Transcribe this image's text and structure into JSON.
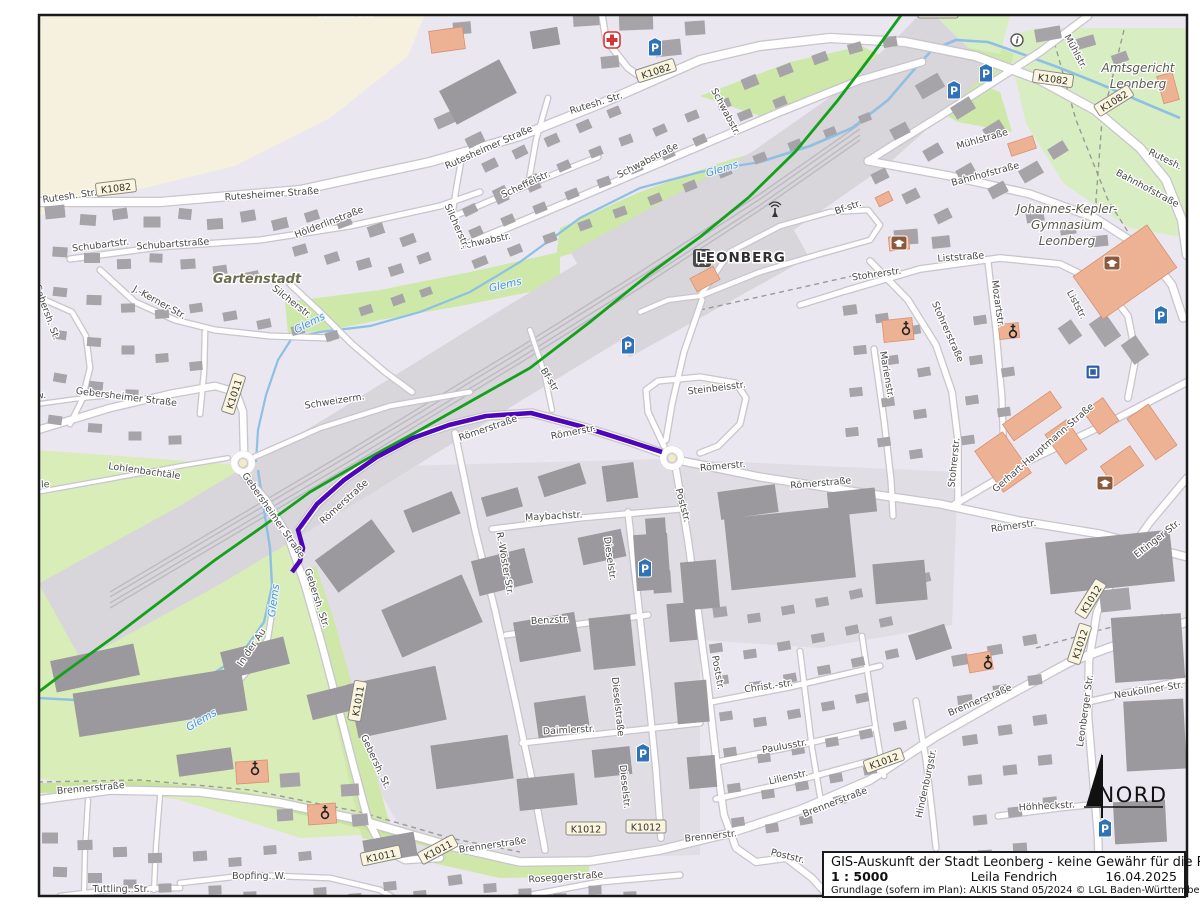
{
  "info_box": {
    "disclaimer": "GIS-Auskunft der Stadt Leonberg - keine Gewähr für die Richtigkeit",
    "scale": "1 : 5000",
    "author": "Leila Fendrich",
    "date": "16.04.2025",
    "source": "Grundlage (sofern im Plan): ALKIS Stand 05/2024 © LGL Baden-Württemberg"
  },
  "north_arrow": {
    "label": "NORD"
  },
  "map": {
    "colors": {
      "background": "#ebe7f1",
      "field": "#f6f1de",
      "grass": "#cde8a8",
      "park": "#d8eec2",
      "building": "#a6a4a8",
      "big_building": "#9b999d",
      "public_building": "#edb294",
      "water": "#8ec0e3",
      "road_fill": "#ffffff",
      "road_casing": "#c8c5cc",
      "railway_band": "#d8d5db",
      "route_highlight": "#4e06b8",
      "railway_line": "#13a01b",
      "parking_blue": "#2f72b7",
      "hospital_red": "#d23737",
      "school_brown": "#8a5a3c"
    },
    "route_highlight": {
      "name": "selected-route",
      "color": "#4e06b8",
      "width": 4.6,
      "points": "662,452 628,441 580,426 531,413 486,416 449,425 413,438 377,457 344,480 317,504 298,530 303,548 300,561 292,572"
    },
    "railway_line": {
      "color": "#13a01b",
      "width": 2.8,
      "points": "910,3 872,55 838,100 795,152 748,198 700,237 648,275 590,322 530,368 473,400 420,430 365,460 310,492 262,527 215,560 165,598 115,636 65,672 20,706"
    },
    "street_labels": [
      {
        "t": "Rütesh. Str.",
        "x": 346,
        "y": 16,
        "r": 0
      },
      {
        "t": "WhA Clausenmühle",
        "x": 1000,
        "y": 11,
        "r": 0,
        "k": "place"
      },
      {
        "t": "Rutesh. Str.",
        "x": 70,
        "y": 199,
        "r": -8
      },
      {
        "t": "Rutesheimer Straße",
        "x": 272,
        "y": 197,
        "r": -4
      },
      {
        "t": "Rutesheimer Straße",
        "x": 490,
        "y": 150,
        "r": -24
      },
      {
        "t": "Rutesh. Str.",
        "x": 597,
        "y": 106,
        "r": -17
      },
      {
        "t": "Schwabstraße",
        "x": 649,
        "y": 163,
        "r": -27
      },
      {
        "t": "Scheffelstr.",
        "x": 527,
        "y": 187,
        "r": -25
      },
      {
        "t": "Schwabstr.",
        "x": 486,
        "y": 244,
        "r": -12
      },
      {
        "t": "Schwabstr.",
        "x": 723,
        "y": 113,
        "r": 62
      },
      {
        "t": "Schubartstr.",
        "x": 101,
        "y": 248,
        "r": -7
      },
      {
        "t": "Schubartstraße",
        "x": 173,
        "y": 247,
        "r": -4
      },
      {
        "t": "Hölderlinstraße",
        "x": 330,
        "y": 225,
        "r": -21
      },
      {
        "t": "Gartenstadt",
        "x": 257,
        "y": 283,
        "r": 0,
        "k": "town"
      },
      {
        "t": "J.-Kerner-Str.",
        "x": 158,
        "y": 305,
        "r": 29
      },
      {
        "t": "Silcherstr.",
        "x": 290,
        "y": 304,
        "r": 38
      },
      {
        "t": "Silcherstr.",
        "x": 454,
        "y": 227,
        "r": 66
      },
      {
        "t": "Gebersh. St.",
        "x": 44,
        "y": 313,
        "r": 70
      },
      {
        "t": "Glems",
        "x": 506,
        "y": 288,
        "r": -13,
        "k": "water"
      },
      {
        "t": "Glems",
        "x": 311,
        "y": 326,
        "r": -27,
        "k": "water"
      },
      {
        "t": "Glems",
        "x": 723,
        "y": 172,
        "r": -17,
        "k": "water"
      },
      {
        "t": "Glems",
        "x": 203,
        "y": 723,
        "r": -30,
        "k": "water"
      },
      {
        "t": "Glems",
        "x": 277,
        "y": 601,
        "r": -82,
        "k": "water"
      },
      {
        "t": "Gebersheimer Straße",
        "x": 126,
        "y": 400,
        "r": 7
      },
      {
        "t": "bachw.",
        "x": 30,
        "y": 400,
        "r": -8
      },
      {
        "t": "Lohlenbachtäle",
        "x": 144,
        "y": 474,
        "r": 8
      },
      {
        "t": "nbachtäle",
        "x": 26,
        "y": 488,
        "r": -2
      },
      {
        "t": "Schweizerm.",
        "x": 335,
        "y": 404,
        "r": -9
      },
      {
        "t": "Gebersheimer Straße",
        "x": 271,
        "y": 517,
        "r": 55
      },
      {
        "t": "Gebersh. Str.",
        "x": 314,
        "y": 599,
        "r": 72
      },
      {
        "t": "Gebersh. St.",
        "x": 373,
        "y": 763,
        "r": 65
      },
      {
        "t": "Römerstraße",
        "x": 489,
        "y": 431,
        "r": -19
      },
      {
        "t": "Römerstr.",
        "x": 574,
        "y": 435,
        "r": -11
      },
      {
        "t": "Römerstraße",
        "x": 346,
        "y": 504,
        "r": -42
      },
      {
        "t": "Bf-str.",
        "x": 849,
        "y": 210,
        "r": -19
      },
      {
        "t": "Bf-str",
        "x": 547,
        "y": 381,
        "r": 58
      },
      {
        "t": "LEONBERG",
        "x": 741,
        "y": 262,
        "r": 0,
        "k": "station"
      },
      {
        "t": "Stohrerstr.",
        "x": 877,
        "y": 277,
        "r": -8
      },
      {
        "t": "Liststraße",
        "x": 961,
        "y": 260,
        "r": -4
      },
      {
        "t": "Stohrerstraße",
        "x": 945,
        "y": 333,
        "r": 66
      },
      {
        "t": "Mozartstr.",
        "x": 995,
        "y": 304,
        "r": 82
      },
      {
        "t": "Marienstr.",
        "x": 884,
        "y": 375,
        "r": 80
      },
      {
        "t": "Steinbeisstr.",
        "x": 717,
        "y": 391,
        "r": -7
      },
      {
        "t": "Maybachstr.",
        "x": 554,
        "y": 519,
        "r": -3
      },
      {
        "t": "R.-Wöster-Str.",
        "x": 502,
        "y": 564,
        "r": 80
      },
      {
        "t": "Dieselstr.",
        "x": 607,
        "y": 559,
        "r": 82
      },
      {
        "t": "Dieselstraße",
        "x": 615,
        "y": 707,
        "r": 84
      },
      {
        "t": "Dieselstr.",
        "x": 622,
        "y": 787,
        "r": 84
      },
      {
        "t": "Poststr.",
        "x": 680,
        "y": 506,
        "r": 75
      },
      {
        "t": "Poststr.",
        "x": 715,
        "y": 673,
        "r": 80
      },
      {
        "t": "Poststr.",
        "x": 787,
        "y": 859,
        "r": 14
      },
      {
        "t": "Benzstr.",
        "x": 550,
        "y": 623,
        "r": -3
      },
      {
        "t": "Daimlerstr.",
        "x": 569,
        "y": 733,
        "r": -3
      },
      {
        "t": "Brennerstraße",
        "x": 91,
        "y": 791,
        "r": -5
      },
      {
        "t": "Brennerstraße",
        "x": 493,
        "y": 848,
        "r": -8
      },
      {
        "t": "Roseggerstraße",
        "x": 566,
        "y": 880,
        "r": -4
      },
      {
        "t": "Bopfing. W.",
        "x": 259,
        "y": 879,
        "r": 0
      },
      {
        "t": "Tuttling. Str.",
        "x": 121,
        "y": 892,
        "r": 0
      },
      {
        "t": "Brennerstr.",
        "x": 711,
        "y": 839,
        "r": -6
      },
      {
        "t": "Brennerstraße",
        "x": 836,
        "y": 805,
        "r": -21
      },
      {
        "t": "Brennerstraße",
        "x": 981,
        "y": 703,
        "r": -23
      },
      {
        "t": "Christ.-str.",
        "x": 769,
        "y": 689,
        "r": -8
      },
      {
        "t": "Paulusstr.",
        "x": 785,
        "y": 749,
        "r": -10
      },
      {
        "t": "Lilienstr.",
        "x": 789,
        "y": 780,
        "r": -13
      },
      {
        "t": "Hindenburgstr.",
        "x": 929,
        "y": 784,
        "r": -78
      },
      {
        "t": "Höhheckstr.",
        "x": 1047,
        "y": 809,
        "r": -3
      },
      {
        "t": "Neuköllner Str.",
        "x": 1149,
        "y": 693,
        "r": -9
      },
      {
        "t": "Leonberger Str.",
        "x": 1088,
        "y": 711,
        "r": -82
      },
      {
        "t": "Eltinger Str.",
        "x": 1159,
        "y": 541,
        "r": -38
      },
      {
        "t": "Römerstr.",
        "x": 723,
        "y": 469,
        "r": -5
      },
      {
        "t": "Römerstraße",
        "x": 821,
        "y": 486,
        "r": -5
      },
      {
        "t": "Römerstr.",
        "x": 1014,
        "y": 529,
        "r": -8
      },
      {
        "t": "Gerhart-Hauptmann-Straße",
        "x": 1045,
        "y": 450,
        "r": -41
      },
      {
        "t": "Stohrerstr.",
        "x": 957,
        "y": 463,
        "r": -84
      },
      {
        "t": "Mühlstraße",
        "x": 983,
        "y": 142,
        "r": -16
      },
      {
        "t": "Bahnhofstraße",
        "x": 986,
        "y": 177,
        "r": -15
      },
      {
        "t": "Bahnhofstraße",
        "x": 1146,
        "y": 191,
        "r": 28
      },
      {
        "t": "Mühlstr.",
        "x": 1073,
        "y": 53,
        "r": 62
      },
      {
        "t": "Rutesh.",
        "x": 1164,
        "y": 162,
        "r": 26
      },
      {
        "t": "Liststr.",
        "x": 1074,
        "y": 306,
        "r": 62
      },
      {
        "t": "In der Au",
        "x": 254,
        "y": 649,
        "r": -56
      },
      {
        "t": "Amtsgericht",
        "x": 1138,
        "y": 72,
        "r": 0,
        "k": "place"
      },
      {
        "t": "Leonberg",
        "x": 1138,
        "y": 88,
        "r": 0,
        "k": "place"
      },
      {
        "t": "Johannes-Kepler-",
        "x": 1067,
        "y": 213,
        "r": 0,
        "k": "place"
      },
      {
        "t": "Gymnasium",
        "x": 1067,
        "y": 229,
        "r": 0,
        "k": "place"
      },
      {
        "t": "Leonberg",
        "x": 1067,
        "y": 245,
        "r": 0,
        "k": "place"
      }
    ],
    "road_shields": [
      {
        "t": "K1082",
        "x": 938,
        "y": 12,
        "r": 0
      },
      {
        "t": "K1082",
        "x": 116,
        "y": 188,
        "r": -7
      },
      {
        "t": "K1082",
        "x": 656,
        "y": 71,
        "r": -18
      },
      {
        "t": "K1082",
        "x": 1053,
        "y": 79,
        "r": 8
      },
      {
        "t": "K1082",
        "x": 1114,
        "y": 101,
        "r": -32
      },
      {
        "t": "K1011",
        "x": 234,
        "y": 394,
        "r": -72
      },
      {
        "t": "K1011",
        "x": 358,
        "y": 701,
        "r": -80
      },
      {
        "t": "K1011",
        "x": 381,
        "y": 856,
        "r": -12
      },
      {
        "t": "K1011",
        "x": 438,
        "y": 850,
        "r": -28
      },
      {
        "t": "K1012",
        "x": 586,
        "y": 829,
        "r": 0
      },
      {
        "t": "K1012",
        "x": 646,
        "y": 827,
        "r": 0
      },
      {
        "t": "K1012",
        "x": 884,
        "y": 761,
        "r": -20
      },
      {
        "t": "K1012",
        "x": 1091,
        "y": 599,
        "r": -58
      },
      {
        "t": "K1012",
        "x": 1080,
        "y": 644,
        "r": -72
      }
    ],
    "icons": [
      {
        "k": "hospital",
        "x": 612,
        "y": 40
      },
      {
        "k": "parking",
        "x": 655,
        "y": 47
      },
      {
        "k": "parking",
        "x": 986,
        "y": 73
      },
      {
        "k": "parking",
        "x": 954,
        "y": 90
      },
      {
        "k": "parking",
        "x": 628,
        "y": 345
      },
      {
        "k": "parking",
        "x": 645,
        "y": 568
      },
      {
        "k": "parking",
        "x": 643,
        "y": 753
      },
      {
        "k": "parking",
        "x": 1105,
        "y": 828
      },
      {
        "k": "parking",
        "x": 1161,
        "y": 315
      },
      {
        "k": "blue-square",
        "x": 1093,
        "y": 372
      },
      {
        "k": "school",
        "x": 899,
        "y": 243
      },
      {
        "k": "school",
        "x": 1112,
        "y": 263
      },
      {
        "k": "school",
        "x": 1105,
        "y": 483
      },
      {
        "k": "church",
        "x": 906,
        "y": 330
      },
      {
        "k": "church",
        "x": 1013,
        "y": 333
      },
      {
        "k": "church",
        "x": 255,
        "y": 770
      },
      {
        "k": "church",
        "x": 325,
        "y": 814
      },
      {
        "k": "church",
        "x": 988,
        "y": 664
      },
      {
        "k": "info",
        "x": 1017,
        "y": 40
      },
      {
        "k": "antenna",
        "x": 775,
        "y": 213
      },
      {
        "k": "station",
        "x": 702,
        "y": 258
      }
    ]
  }
}
